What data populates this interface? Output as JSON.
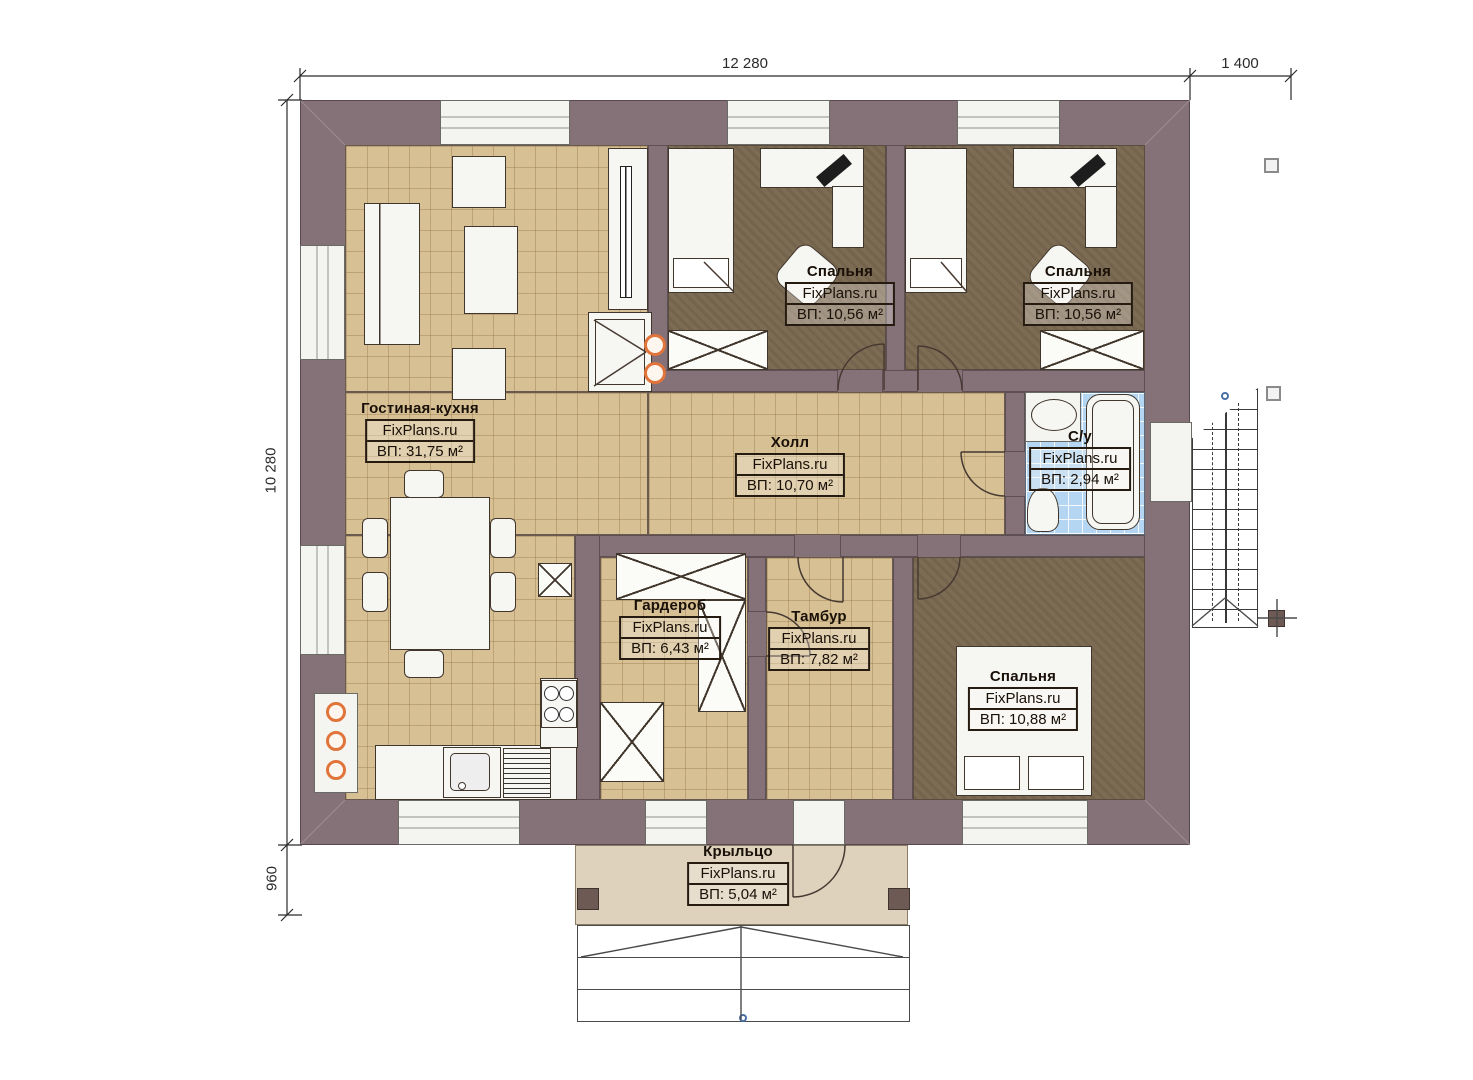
{
  "brand": "FixPlans.ru",
  "dimensions": {
    "width_total": "12 280",
    "stair_width": "1 400",
    "height_total": "10 280",
    "porch_depth": "960"
  },
  "rooms": [
    {
      "id": "living-kitchen",
      "name": "Гостиная-кухня",
      "brand": "FixPlans.ru",
      "area": "ВП: 31,75 м²"
    },
    {
      "id": "bedroom-1",
      "name": "Спальня",
      "brand": "FixPlans.ru",
      "area": "ВП: 10,56 м²"
    },
    {
      "id": "bedroom-2",
      "name": "Спальня",
      "brand": "FixPlans.ru",
      "area": "ВП: 10,56 м²"
    },
    {
      "id": "hall",
      "name": "Холл",
      "brand": "FixPlans.ru",
      "area": "ВП: 10,70 м²"
    },
    {
      "id": "bathroom",
      "name": "С/у",
      "brand": "FixPlans.ru",
      "area": "ВП: 2,94 м²"
    },
    {
      "id": "wardrobe",
      "name": "Гардероб",
      "brand": "FixPlans.ru",
      "area": "ВП: 6,43 м²"
    },
    {
      "id": "vestibule",
      "name": "Тамбур",
      "brand": "FixPlans.ru",
      "area": "ВП: 7,82 м²"
    },
    {
      "id": "bedroom-3",
      "name": "Спальня",
      "brand": "FixPlans.ru",
      "area": "ВП: 10,88 м²"
    },
    {
      "id": "porch",
      "name": "Крыльцо",
      "brand": "FixPlans.ru",
      "area": "ВП: 5,04 м²"
    }
  ],
  "colors": {
    "wall": "#857278",
    "floor_tile": "#d6c094",
    "floor_bedroom": "#7d6c54",
    "floor_bathroom": "#b5d6f2",
    "floor_porch": "#ded2bc",
    "accent_orange": "#e0743a",
    "marker_blue": "#4a6fa5"
  }
}
